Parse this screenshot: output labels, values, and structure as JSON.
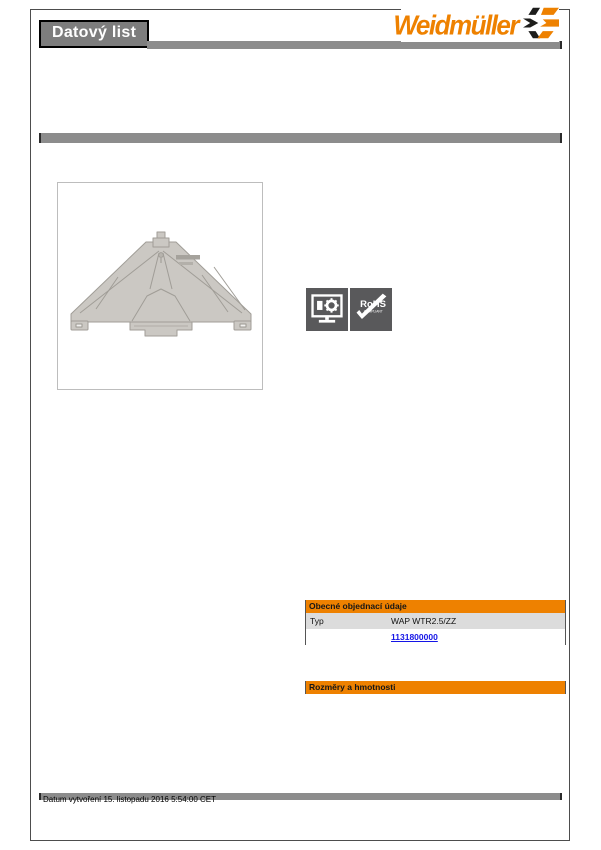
{
  "colors": {
    "brand_orange": "#EE8100",
    "link_blue": "#1414E6",
    "bar_gray": "#8C8C8C",
    "badge_gray": "#59595B"
  },
  "header": {
    "doc_type_label": "Datový list",
    "brand_name": "Weidmüller"
  },
  "badges": {
    "rohs_line1": "RoHS",
    "rohs_line2": "COMPLIANT"
  },
  "ordering": {
    "section_title": "Obecné objednací údaje",
    "type_label": "Typ",
    "type_value": "WAP WTR2.5/ZZ",
    "order_number": "1131800000"
  },
  "section2": {
    "title": "Rozměry a hmotnosti"
  },
  "footer": {
    "created": "Datum vytvoření 15. listopadu 2016 5:54:00 CET"
  }
}
